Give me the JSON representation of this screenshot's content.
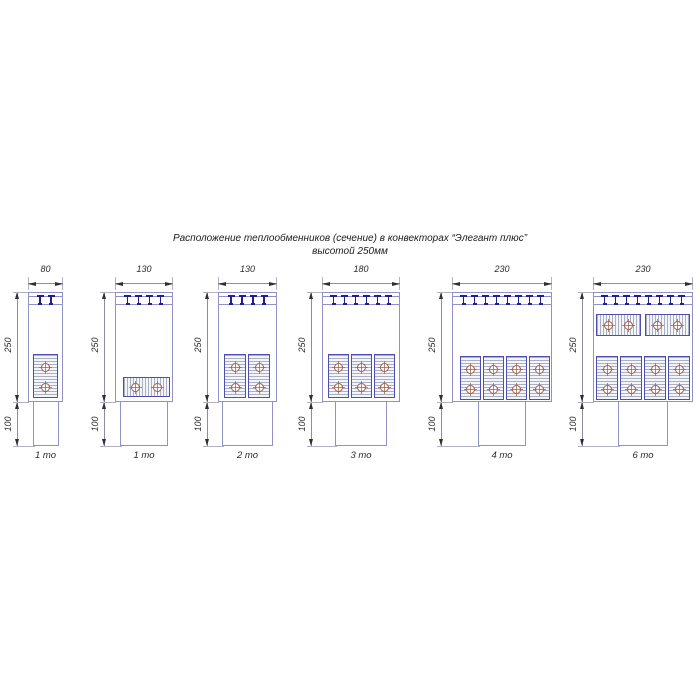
{
  "title": {
    "line1": "Расположение теплообменников (сечение) в конвекторах “Элегант плюс”",
    "line2": "высотой 250мм"
  },
  "colors": {
    "outline": "#9191c8",
    "block_border": "#4d4db2",
    "hatch_line": "#a9afc4",
    "hatch_bg": "#f4f5f8",
    "clip": "#1e1e96",
    "tube": "#a55a42",
    "tube_cross": "#9a6a55",
    "dim_line": "#8c8ca8",
    "arrow": "#2f2f2f",
    "ext_line": "#b2b2c4",
    "text": "#2b2b2b"
  },
  "figures": [
    {
      "caption": "1 то",
      "width_label": "80",
      "height_label": "250",
      "pedestal_label": "100",
      "clip_count": 2,
      "geom": {
        "left": 28,
        "width": 35,
        "ped_width": 26
      },
      "exchangers": [
        {
          "dir": "v",
          "x": 33,
          "y": 354,
          "w": 25,
          "h": 44
        }
      ]
    },
    {
      "caption": "1 то",
      "width_label": "130",
      "height_label": "250",
      "pedestal_label": "100",
      "clip_count": 4,
      "geom": {
        "left": 115,
        "width": 58,
        "ped_width": 48
      },
      "exchangers": [
        {
          "dir": "h",
          "x": 123,
          "y": 377,
          "w": 47,
          "h": 20
        }
      ]
    },
    {
      "caption": "2 то",
      "width_label": "130",
      "height_label": "250",
      "pedestal_label": "100",
      "clip_count": 4,
      "geom": {
        "left": 218,
        "width": 59,
        "ped_width": 51
      },
      "exchangers": [
        {
          "dir": "v",
          "x": 224,
          "y": 354,
          "w": 22,
          "h": 44
        },
        {
          "dir": "v",
          "x": 248,
          "y": 354,
          "w": 22,
          "h": 44
        }
      ]
    },
    {
      "caption": "3 то",
      "width_label": "180",
      "height_label": "250",
      "pedestal_label": "100",
      "clip_count": 6,
      "geom": {
        "left": 322,
        "width": 78,
        "ped_width": 52
      },
      "exchangers": [
        {
          "dir": "v",
          "x": 328,
          "y": 354,
          "w": 21,
          "h": 44
        },
        {
          "dir": "v",
          "x": 351,
          "y": 354,
          "w": 21,
          "h": 44
        },
        {
          "dir": "v",
          "x": 374,
          "y": 354,
          "w": 21,
          "h": 44
        }
      ]
    },
    {
      "caption": "4 то",
      "width_label": "230",
      "height_label": "250",
      "pedestal_label": "100",
      "clip_count": 8,
      "geom": {
        "left": 452,
        "width": 100,
        "ped_width": 48
      },
      "exchangers": [
        {
          "dir": "v",
          "x": 460,
          "y": 356,
          "w": 21,
          "h": 44
        },
        {
          "dir": "v",
          "x": 483,
          "y": 356,
          "w": 21,
          "h": 44
        },
        {
          "dir": "v",
          "x": 506,
          "y": 356,
          "w": 21,
          "h": 44
        },
        {
          "dir": "v",
          "x": 529,
          "y": 356,
          "w": 21,
          "h": 44
        }
      ]
    },
    {
      "caption": "6 то",
      "width_label": "230",
      "height_label": "250",
      "pedestal_label": "100",
      "clip_count": 8,
      "geom": {
        "left": 593,
        "width": 100,
        "ped_width": 50
      },
      "exchangers": [
        {
          "dir": "h",
          "x": 596,
          "y": 314,
          "w": 45,
          "h": 22
        },
        {
          "dir": "h",
          "x": 645,
          "y": 314,
          "w": 45,
          "h": 22
        },
        {
          "dir": "v",
          "x": 596,
          "y": 356,
          "w": 22,
          "h": 44
        },
        {
          "dir": "v",
          "x": 620,
          "y": 356,
          "w": 22,
          "h": 44
        },
        {
          "dir": "v",
          "x": 644,
          "y": 356,
          "w": 22,
          "h": 44
        },
        {
          "dir": "v",
          "x": 668,
          "y": 356,
          "w": 22,
          "h": 44
        }
      ]
    }
  ]
}
